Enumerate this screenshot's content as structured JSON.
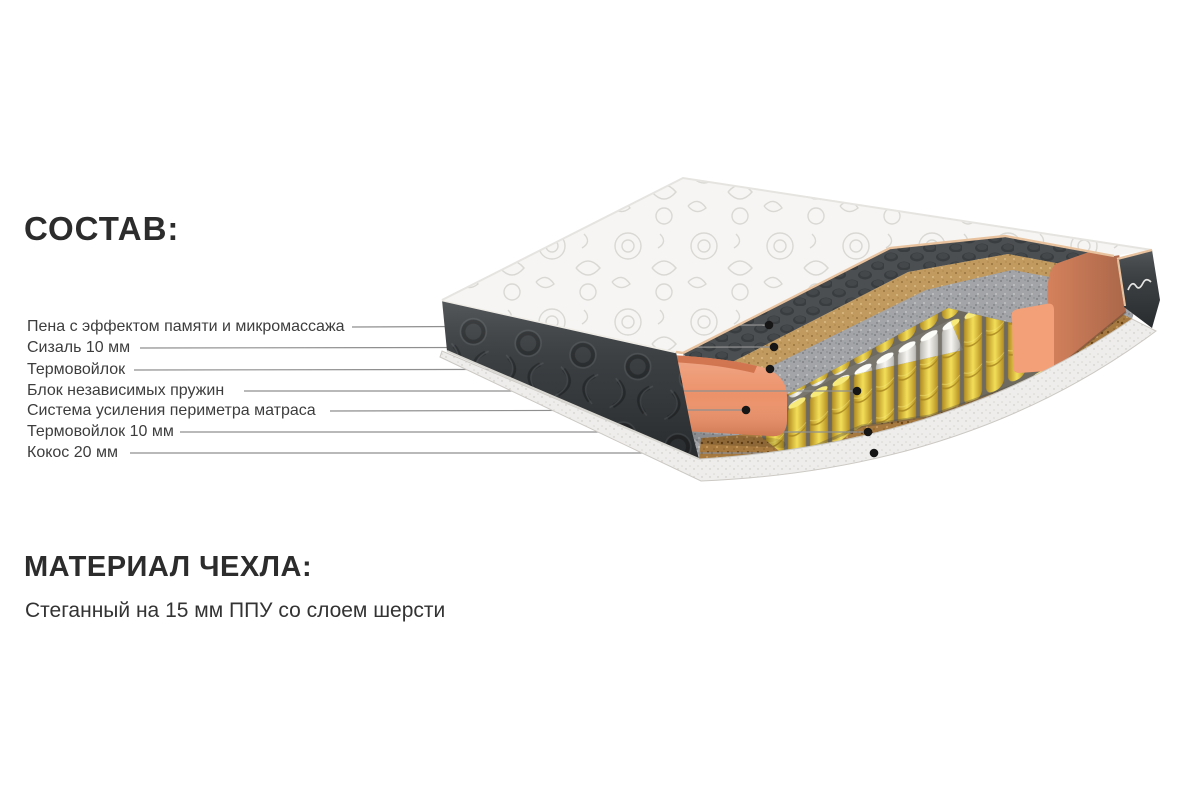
{
  "page": {
    "background": "#ffffff"
  },
  "sections": {
    "composition": {
      "heading": "СОСТАВ:",
      "items": [
        {
          "label": "Пена с эффектом памяти и микромассажа",
          "layer": "memory-foam"
        },
        {
          "label": "Сизаль 10 мм",
          "layer": "sisal"
        },
        {
          "label": "Термовойлок",
          "layer": "thermo-felt"
        },
        {
          "label": "Блок независимых пружин",
          "layer": "independent-spring-block"
        },
        {
          "label": "Система усиления периметра матраса",
          "layer": "perimeter-reinforcement-foam"
        },
        {
          "label": "Термовойлок 10 мм",
          "layer": "thermo-felt-10mm"
        },
        {
          "label": "Кокос 20 мм",
          "layer": "coconut-20mm"
        }
      ]
    },
    "cover_material": {
      "heading": "МАТЕРИАЛ ЧЕХЛА:",
      "description": "Стеганный на 15 мм ППУ со слоем шерсти"
    }
  },
  "colors": {
    "heading_text": "#2c2c2c",
    "label_text": "#3d3d3d",
    "leader_line": "#8f8f8f",
    "marker_dot": "#161616",
    "cover_fabric": "#f6f5f3",
    "cover_piping": "#e8c29e",
    "side_fabric_dark": "#3a3e41",
    "memory_foam": "#4b4f52",
    "sisal": "#c19a60",
    "thermo_felt": "#a2a4a7",
    "spring_yellow": "#f3df58",
    "spring_white": "#f4f3ef",
    "perimeter_foam": "#ec8f66",
    "coconut": "#a5793f",
    "bottom_rim": "#eeedeb"
  }
}
